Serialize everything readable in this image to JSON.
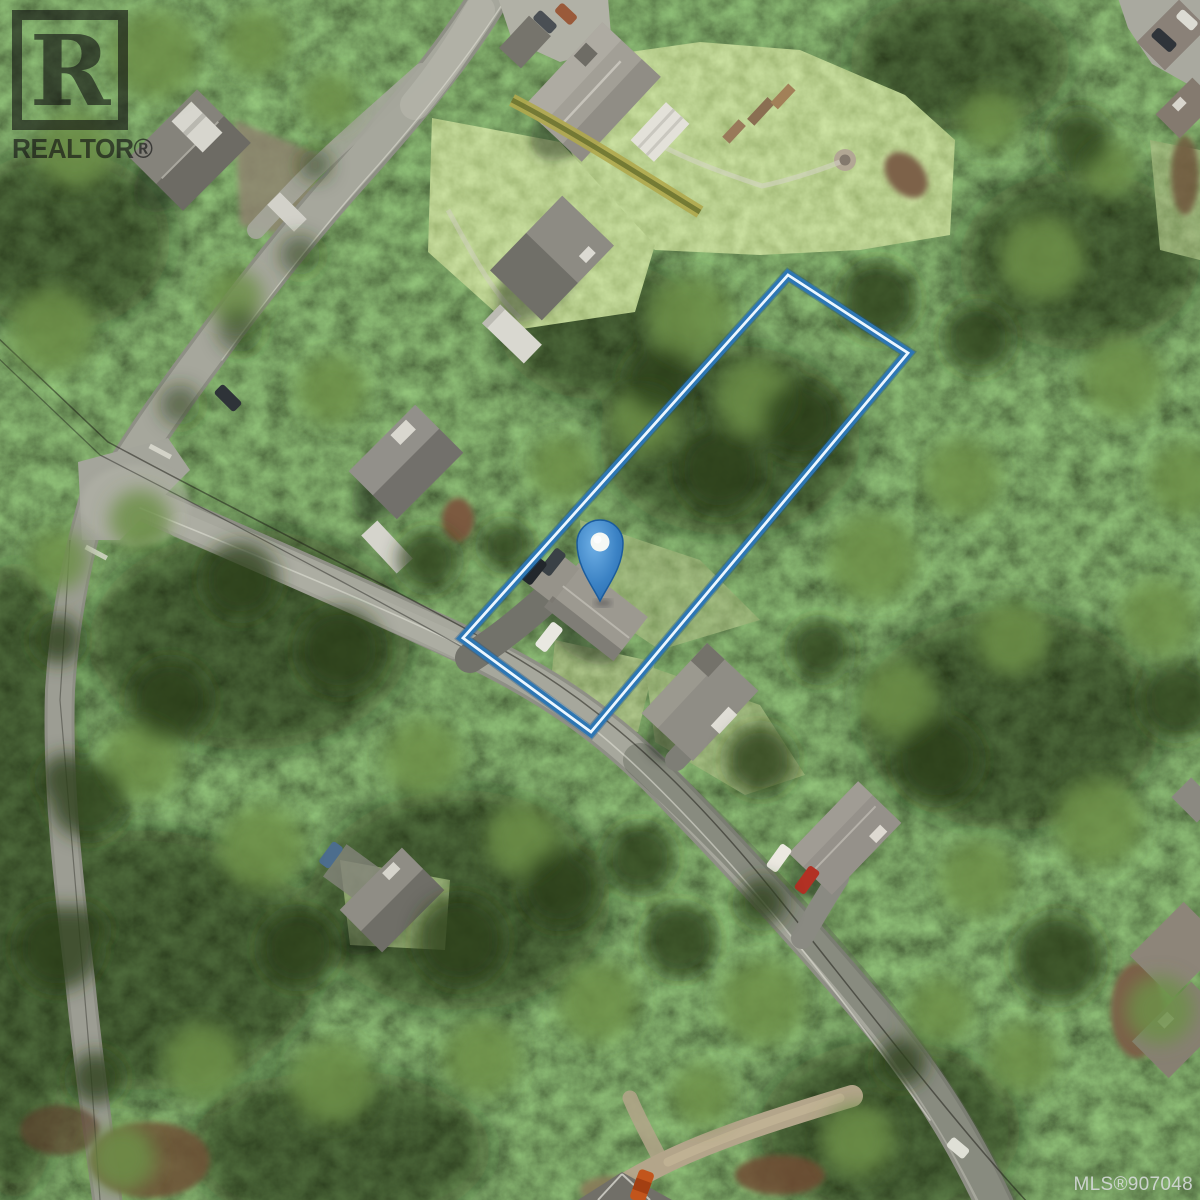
{
  "watermarks": {
    "realtor_logo_letter": "R",
    "realtor_brand": "REALTOR®",
    "mls_label": "MLS®907048"
  },
  "map": {
    "view_type": "satellite aerial photo",
    "marker": {
      "transform_attr": "translate(600,543)",
      "fill": "#3d86c9",
      "border": "#1b5c9d",
      "inner_dot": "#f5f8f4"
    },
    "property_boundary": {
      "points_attr": "788,275 908,353 591,732 463,638",
      "stroke_outer": "#2d76b3",
      "stroke_inner": "#ecf7ff"
    }
  }
}
